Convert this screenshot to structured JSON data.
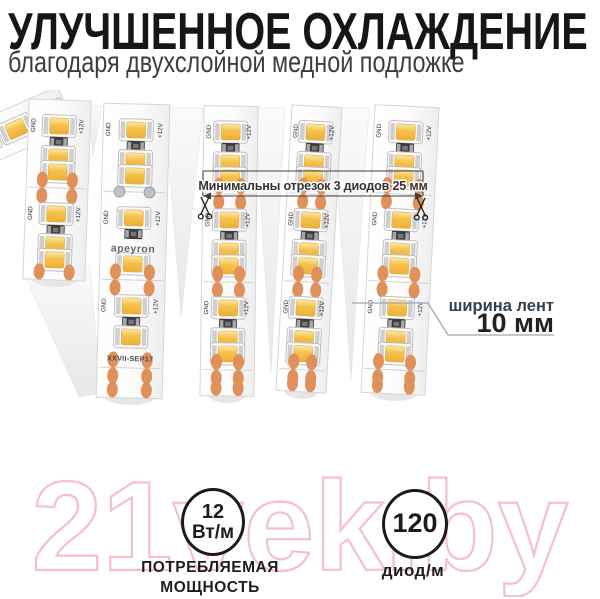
{
  "header": {
    "title": "УЛУЧШЕННОЕ ОХЛАЖДЕНИЕ",
    "subtitle": "благодаря двухслойной медной подложке"
  },
  "diagram": {
    "cut_note": "Минимальны отрезок 3 диодов 25 мм",
    "width_caption": "ширина лент",
    "width_value": "10 мм",
    "strip_brand": "apeyron",
    "strip_batch": "XXVII-SEP17",
    "pad_label_gnd": "GND",
    "pad_label_12v": "+12V",
    "icons": {
      "scissors": "✂"
    },
    "led_color": "#f5c049",
    "pad_color": "#e0905a"
  },
  "badges": {
    "power": {
      "value": "12",
      "unit": "Вт/м",
      "caption_line1": "ПОТРЕБЛЯЕМАЯ",
      "caption_line2": "МОЩНОСТЬ"
    },
    "density": {
      "value": "120",
      "caption": "диод/м"
    }
  },
  "watermark": {
    "text": "21vek.by",
    "color": "#f5bfcd"
  }
}
